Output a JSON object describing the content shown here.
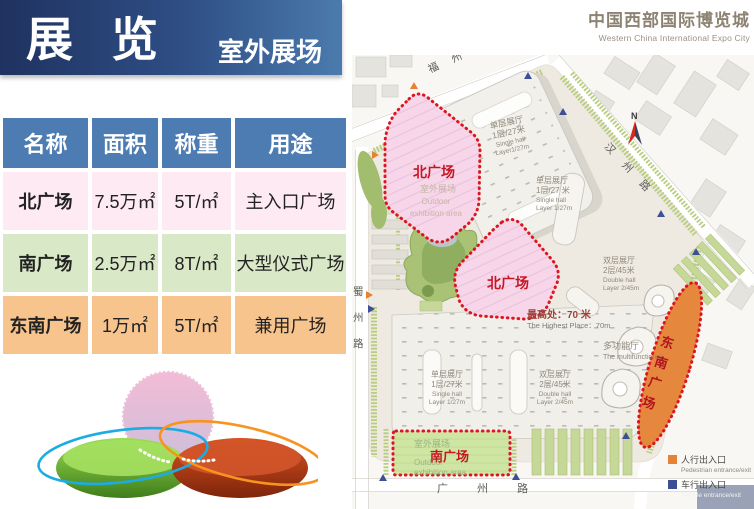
{
  "header": {
    "title": "展览",
    "subtitle": "室外展场"
  },
  "brand": {
    "cn": "中国西部国际博览城",
    "en": "Western China International  Expo City"
  },
  "table": {
    "headers": [
      "名称",
      "面积",
      "称重",
      "用途"
    ],
    "rows": [
      {
        "name": "北广场",
        "area": "7.5万㎡",
        "load": "5T/㎡",
        "use": "主入口广场",
        "bg": "#fdeaf3"
      },
      {
        "name": "南广场",
        "area": "2.5万㎡",
        "load": "8T/㎡",
        "use": "大型仪式广场",
        "bg": "#d9e8c6"
      },
      {
        "name": "东南广场",
        "area": "1万㎡",
        "load": "5T/㎡",
        "use": "兼用广场",
        "bg": "#f8c48d"
      }
    ]
  },
  "map": {
    "roads": {
      "top": "福 州 路",
      "right": "汉 州 路",
      "left_chars": [
        "蜀",
        "州",
        "路"
      ],
      "bottom": "广 州 路"
    },
    "compass": "N",
    "halls": {
      "top_single": {
        "cn": "单层展厅",
        "spec": "1层/27米",
        "en1": "Single hall",
        "en2": "Layer1/27m"
      },
      "right_single": {
        "cn": "单层展厅",
        "spec": "1层/27 米",
        "en1": "Single hall",
        "en2": "Layer 1/27m"
      },
      "right_double": {
        "cn": "双层展厅",
        "spec": "2层/45米",
        "en1": "Double hall",
        "en2": "Layer 2/45m"
      },
      "bottom_single": {
        "cn": "单层展厅",
        "spec": "1层/27米",
        "en1": "Single hall",
        "en2": "Layer 1/27m"
      },
      "bottom_double": {
        "cn": "双层展厅",
        "spec": "2层/45米",
        "en1": "Double hall",
        "en2": "Layer 2/45m"
      }
    },
    "notes": {
      "highest_cn": "最高处：70 米",
      "highest_en": "The Highest Place：70m",
      "multi_cn": "多功能厅",
      "multi_en": "The multifunctional"
    },
    "plazas": {
      "north1": {
        "label": "北广场",
        "sub1": "室外展场",
        "sub2": "Outdoor",
        "sub3": "exhibition area"
      },
      "north2": {
        "label": "北广场"
      },
      "south": {
        "label": "南广场",
        "sub1": "室外展场",
        "sub2": "Outdoor",
        "sub3": "exhibition area"
      },
      "southeast_chars": [
        "东",
        "南",
        "广",
        "场"
      ]
    },
    "legend": {
      "pedestrian_cn": "人行出入口",
      "pedestrian_en": "Pedestrian entrance/exit",
      "pedestrian_color": "#e58234",
      "vehicle_cn": "车行出入口",
      "vehicle_en": "Vehicle entrance/exit",
      "vehicle_color": "#3d5096"
    },
    "colors": {
      "plaza_pink": "#f7d6e9",
      "plaza_green": "#cfe5a3",
      "plaza_orange": "#e5873d",
      "border_red": "#de1420"
    }
  }
}
